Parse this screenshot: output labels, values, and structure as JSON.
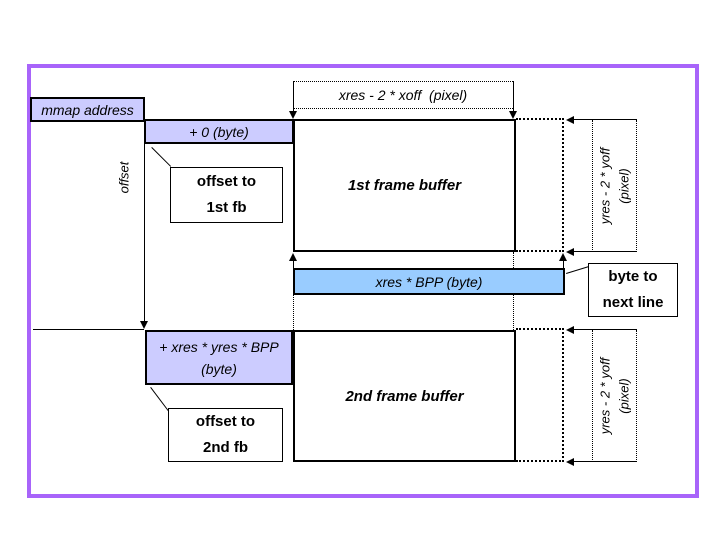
{
  "labels": {
    "mmap_address": "mmap address",
    "offset": "offset",
    "plus_zero_byte": "+ 0 (byte)",
    "offset_to_1st": {
      "line1": "offset to",
      "line2": "1st fb"
    },
    "fb1": "1st frame buffer",
    "xres_dim": "xres - 2 * xoff  (pixel)",
    "yres_dim_top": {
      "line1": "yres - 2 * yoff",
      "line2": "(pixel)"
    },
    "xres_bpp": "xres * BPP (byte)",
    "byte_to_next_line": {
      "line1": "byte to",
      "line2": "next line"
    },
    "plus_fb_size": {
      "line1": "+ xres * yres * BPP",
      "line2": "(byte)"
    },
    "fb2": "2nd frame buffer",
    "offset_to_2nd": {
      "line1": "offset to",
      "line2": "2nd fb"
    },
    "yres_dim_bottom": {
      "line1": "yres - 2 * yoff",
      "line2": "(pixel)"
    }
  },
  "colors": {
    "frame_border": "#a864fa",
    "label_fill": "#ccccff",
    "bar_fill": "#99ccff",
    "line": "#000000",
    "background": "#ffffff"
  }
}
